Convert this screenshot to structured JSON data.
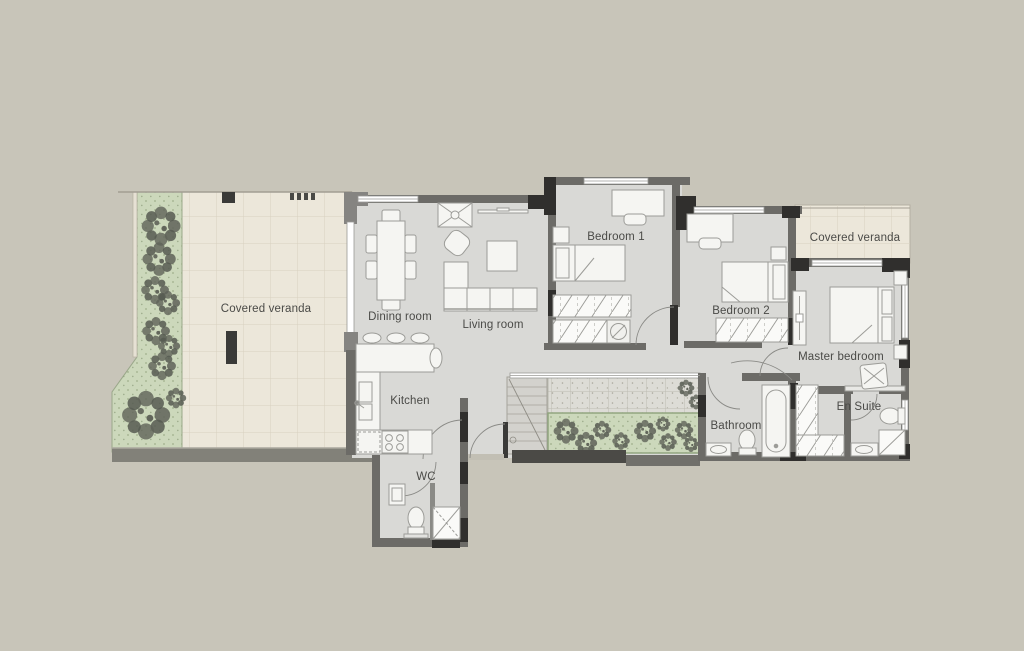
{
  "document": {
    "type": "architectural-floor-plan",
    "view": "top-down apartment plan"
  },
  "rooms": [
    {
      "id": "covered-veranda-left",
      "label": "Covered veranda"
    },
    {
      "id": "dining-room",
      "label": "Dining room"
    },
    {
      "id": "living-room",
      "label": "Living room"
    },
    {
      "id": "kitchen",
      "label": "Kitchen"
    },
    {
      "id": "wc",
      "label": "WC"
    },
    {
      "id": "bedroom-1",
      "label": "Bedroom 1"
    },
    {
      "id": "bedroom-2",
      "label": "Bedroom 2"
    },
    {
      "id": "master-bedroom",
      "label": "Master bedroom"
    },
    {
      "id": "bathroom",
      "label": "Bathroom"
    },
    {
      "id": "en-suite",
      "label": "En Suite"
    },
    {
      "id": "covered-veranda-right",
      "label": "Covered veranda"
    }
  ],
  "colors": {
    "background": "#c8c5b9",
    "interior_floor": "#d9d9d6",
    "wall": "#6c6b67",
    "column": "#302f2d",
    "veranda_tile": "#ece7da",
    "tile_grid_line": "#d8d1c0",
    "planting_bed": "#ccd8bb",
    "shrub": "#5f6359",
    "furniture_fill": "#f5f5f2",
    "furniture_stroke": "#9c9c98",
    "label_text": "#4a4a47"
  },
  "fixtures": {
    "dining_room": [
      "dining-table",
      "dining-chairs"
    ],
    "living_room": [
      "tv-cabinet",
      "wall-tv",
      "armchair",
      "coffee-table",
      "corner-sofa"
    ],
    "kitchen": [
      "breakfast-bar",
      "bar-stools",
      "kitchen-sink",
      "cooktop",
      "counter"
    ],
    "wc": [
      "washbasin",
      "toilet",
      "shower"
    ],
    "bedroom_1": [
      "desk",
      "desk-chair",
      "single-bed",
      "nightstand",
      "wardrobe",
      "washing-machine"
    ],
    "bedroom_2": [
      "desk",
      "desk-chair",
      "single-bed",
      "nightstand",
      "wardrobe"
    ],
    "master_bedroom": [
      "double-bed",
      "nightstand",
      "dresser",
      "bench",
      "walk-in-closet"
    ],
    "bathroom": [
      "bathtub",
      "toilet",
      "washbasin"
    ],
    "en_suite": [
      "toilet",
      "shower",
      "washbasin"
    ],
    "outdoor": [
      "planting-beds",
      "shrubs",
      "pergola",
      "external-staircase",
      "tiled-veranda"
    ]
  }
}
